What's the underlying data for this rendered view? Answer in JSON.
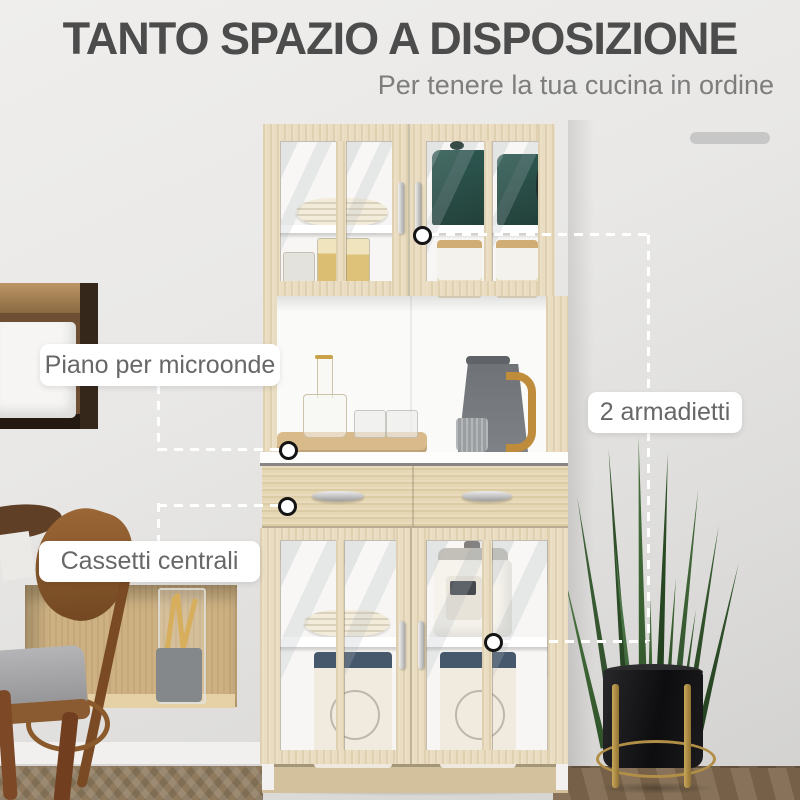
{
  "header": {
    "title": "TANTO SPAZIO A DISPOSIZIONE",
    "subtitle": "Per tenere la tua cucina in ordine"
  },
  "callouts": {
    "microwave_shelf": {
      "label": "Piano per microonde"
    },
    "two_cabinets": {
      "label": "2 armadietti"
    },
    "central_drawers": {
      "label": "Cassetti centrali"
    }
  },
  "colors": {
    "wall_gray": "#e9e8e6",
    "title_text": "#4c4c4c",
    "subtitle_text": "#7d7d7d",
    "label_text": "#676767",
    "callout_line": "#ffffff",
    "cabinet_wood": "#e9dcc0",
    "interior_white": "#f7f6f4",
    "teal_teapot": "#1d443d",
    "navy_lid": "#3c4f63",
    "plant_green": "#3a5c33",
    "pot_black": "#141416",
    "stand_gold": "#b18f47"
  }
}
